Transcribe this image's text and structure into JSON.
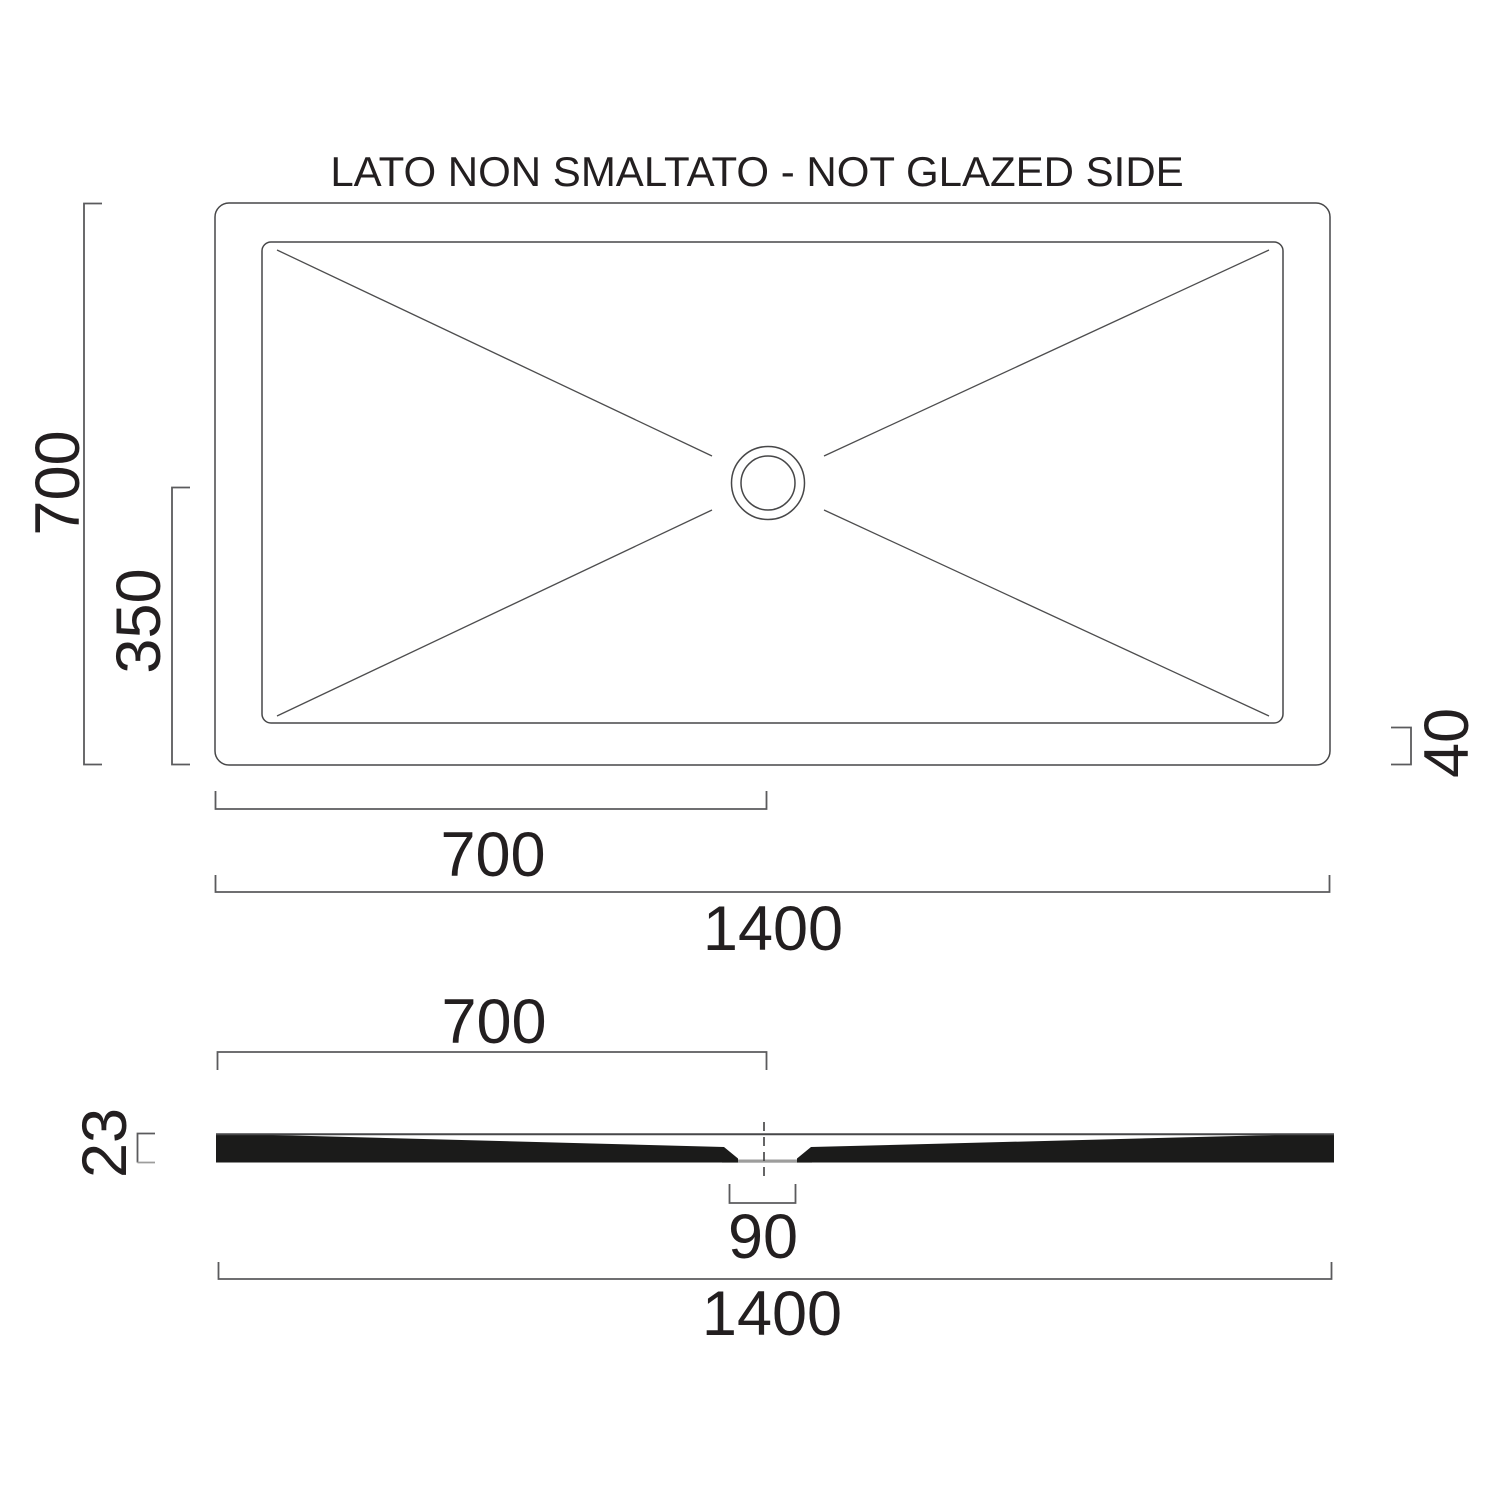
{
  "title": "LATO NON SMALTATO - NOT GLAZED SIDE",
  "colors": {
    "background": "#ffffff",
    "drawing_line": "#474748",
    "dimension_line": "#5b5b5d",
    "gray_accent": "#9d9d9c",
    "section_fill": "#1b1b1a",
    "text": "#231f20"
  },
  "top_view": {
    "vertical_dim": "700",
    "half_vertical_dim": "350",
    "edge_dim": "40",
    "half_horizontal_dim": "700",
    "horizontal_dim": "1400"
  },
  "section_view": {
    "half_width_dim": "700",
    "thickness_dim": "23",
    "drain_dim": "90",
    "width_dim": "1400"
  }
}
